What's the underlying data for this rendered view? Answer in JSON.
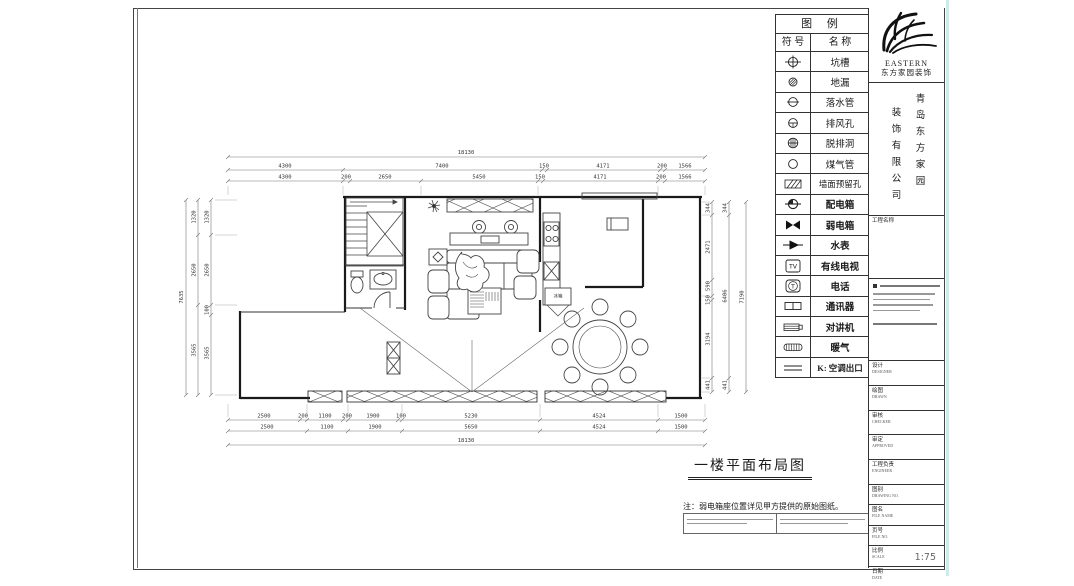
{
  "legend": {
    "title": "图  例",
    "col_symbol": "符 号",
    "col_name": "名 称",
    "rows": [
      {
        "name": "坑槽",
        "icon": "pit-symbol"
      },
      {
        "name": "地漏",
        "icon": "floor-drain-symbol"
      },
      {
        "name": "落水管",
        "icon": "downpipe-symbol"
      },
      {
        "name": "排风孔",
        "icon": "exhaust-vent-symbol"
      },
      {
        "name": "脱排洞",
        "icon": "hood-hole-symbol"
      },
      {
        "name": "煤气管",
        "icon": "gas-pipe-symbol"
      },
      {
        "name": "墙面预留孔",
        "icon": "wall-reserved-hole-symbol"
      },
      {
        "name": "配电箱",
        "icon": "power-distribution-box-symbol"
      },
      {
        "name": "弱电箱",
        "icon": "weak-current-box-symbol"
      },
      {
        "name": "水表",
        "icon": "water-meter-symbol"
      },
      {
        "name": "有线电视",
        "icon": "cable-tv-symbol"
      },
      {
        "name": "电话",
        "icon": "telephone-symbol"
      },
      {
        "name": "通讯器",
        "icon": "communicator-symbol"
      },
      {
        "name": "对讲机",
        "icon": "intercom-symbol"
      },
      {
        "name": "暖气",
        "icon": "radiator-symbol"
      },
      {
        "name": "K: 空调出口",
        "icon": "ac-outlet-symbol"
      }
    ]
  },
  "brand": {
    "logo_en": "EASTERN",
    "logo_zh": "东方家园装饰",
    "company_right": "青岛东方家园",
    "company_left": "装饰有限公司"
  },
  "titleblock": {
    "project_label": "工程名称",
    "rows": [
      {
        "zh": "设计",
        "en": "DESIGNER",
        "value": ""
      },
      {
        "zh": "绘图",
        "en": "DRAWN",
        "value": ""
      },
      {
        "zh": "审核",
        "en": "CHECKER",
        "value": ""
      },
      {
        "zh": "审定",
        "en": "APPROVED",
        "value": ""
      },
      {
        "zh": "工程负责",
        "en": "ENGINEER",
        "value": ""
      },
      {
        "zh": "图别",
        "en": "DRAWING NO.",
        "value": ""
      },
      {
        "zh": "图名",
        "en": "FILE NAME",
        "value": ""
      },
      {
        "zh": "页号",
        "en": "FILE NO.",
        "value": ""
      },
      {
        "zh": "比例",
        "en": "SCALE",
        "value": "1:75"
      },
      {
        "zh": "日期",
        "en": "DATE",
        "value": ""
      }
    ]
  },
  "drawing": {
    "title": "一楼平面布局图",
    "note": "注：弱电箱座位置详见甲方提供的原始图纸。",
    "labels": {
      "fridge": "冰箱"
    },
    "dims": {
      "top_total": "18130",
      "top_row2": [
        "4300",
        "7400",
        "150",
        "4171",
        "200",
        "1566"
      ],
      "top_row3": [
        "4300",
        "200",
        "2650",
        "5450",
        "150",
        "4171",
        "200",
        "1566"
      ],
      "bottom_row1": [
        "2500",
        "200",
        "1100",
        "200",
        "1900",
        "100",
        "5230",
        "4524",
        "1500"
      ],
      "bottom_row2": [
        "2500",
        "1100",
        "1900",
        "5650",
        "4524",
        "1500"
      ],
      "bottom_total": "18130",
      "left_total": "7635",
      "left_mid": [
        "1320",
        "2650",
        "3565"
      ],
      "left_inner": [
        "1320",
        "2650",
        "100",
        "3565"
      ],
      "right_inner": [
        "344",
        "2471",
        "590",
        "150",
        "3194",
        "441"
      ],
      "right_mid": [
        "344",
        "6406",
        "441"
      ],
      "right_total": "7190"
    }
  }
}
